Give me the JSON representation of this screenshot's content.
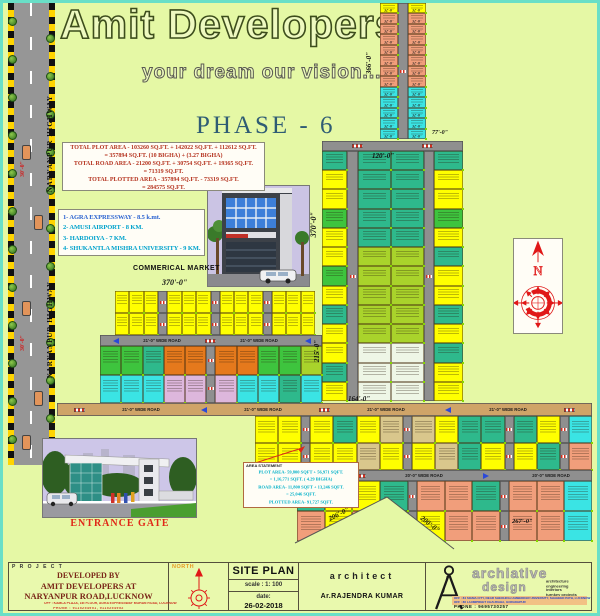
{
  "header": {
    "title": "Amit Developers",
    "tagline": "your dream our vision.......",
    "phase": "PHASE - 6"
  },
  "highway": {
    "label": "NARYANPUR HIGHWAY",
    "width_dim": "30'-0\""
  },
  "area_summary": {
    "l1": "TOTAL PLOT AREA -  103260 SQ.FT. + 142022 SQ.FT. + 112612 SQ.FT.",
    "l2": "= 357894 SQ.FT.    (10 BIGHA) + (3.27 BIGHA)",
    "l3": "TOTAL ROAD AREA -  21200 SQ.FT. + 30754 SQ.FT. + 19365 SQ.FT.",
    "l4": "= 71319 SQ.FT.",
    "l5": "TOTAL PLOTTED AREA - 357894 SQ.FT. - 73319 SQ.FT.",
    "l6": "= 284575 SQ.FT."
  },
  "distances": {
    "items": [
      "1- AGRA EXPRESSWAY - 8.5 k.mt.",
      "2- AMUSI AIRPORT - 8 KM.",
      "3- HARDOIYA - 7 KM.",
      "4- SHUKANTLA MISHRA UNIVERSITY - 9 KM."
    ]
  },
  "commercial_market_label": "COMMERICAL MARKET",
  "entrance_gate_label": "ENTRANCE GATE",
  "area_statement": {
    "header": "AREA STATEMENT",
    "l1": "PLOT AREA- 59,800 SQFT + 56,971 SQFT.",
    "l2": "= 1,16,771 SQFT. ( 4.29 BIGHA)",
    "l3": "ROAD AREA- 11,800 SQFT + 13,246 SQFT.",
    "l4": "= 25,046 SQFT.",
    "l5": "PLOTTED AREA- 91,727 SQFT."
  },
  "plan": {
    "road21": "21'-0\" WIDE ROAD",
    "road20": "20'-0\" WIDE ROAD",
    "strip_label": "32'-0\"",
    "d366": "366'-0\"",
    "d120": "120'-0\"",
    "d77": "77'-0\"",
    "d370a": "370'-0\"",
    "d370b": "370'-0\"",
    "d215": "215'-0\"",
    "d164": "164'-0\"",
    "d267": "267'-0\"",
    "d206": "206'-0\"",
    "d200": "200'-0\""
  },
  "titleblock": {
    "project_label": "P R O J E C T",
    "dev_line1": "DEVELOPED BY",
    "dev_line2": "AMIT DEVELOPERS AT",
    "dev_line3": "NARYANPUR ROAD,LUCKNOW",
    "office1": "OFF : KAMLA PLAZA, 1st FLOOR, AGRA EXPRESSWAY MOHAN ROAD, LUCKNOW",
    "phone1": "PHONE : 9115254951, 9115254952",
    "north_label": "NORTH",
    "siteplan": "SITE PLAN",
    "scale": "scale :  1: 100",
    "date_label": "date:",
    "date_value": "26-02-2018",
    "architect_label": "architect",
    "architect_name": "Ar.RAJENDRA KUMAR",
    "firm_name1": "archiative",
    "firm_name2": "design",
    "firm_services": [
      "architecture",
      "engineering",
      "interiors",
      "turnkey  projects"
    ],
    "firm_office1": "OFF : 84 SIGMA CITY, NEAR SHEOHRAJ AMBEDKER UNIVERSITY, SHAHEED PATH, LUCKNOW",
    "firm_office2": "OFF : 86 LAXMIPREET CHAURAHA, GORAKHPUR",
    "firm_phone": "PHONE :  9695730257"
  },
  "colors": {
    "background": "#e5f8a5",
    "frame": "#69dfc7",
    "road_gray": "#8f8f8f",
    "road_tan": "#cfa468",
    "checker_yellow": "#ffd400",
    "phase_text": "#2f5c74",
    "summary_text": "#b5331f",
    "distance_text": "#00a2cc",
    "entrance_label": "#e02818",
    "compass_red": "#e01818",
    "titleblock_maroon": "#7a2618"
  },
  "palette": {
    "Y": "#ffff00",
    "S": "#f19e7b",
    "C": "#3ae4e4",
    "T": "#2eb98c",
    "G": "#3ec43e",
    "YG": "#a9d32b",
    "W": "#eef6e6",
    "O": "#e5791c",
    "P": "#ddb7dc",
    "TN": "#d9c78c"
  },
  "plot_blocks": {
    "stripA": [
      "Y",
      "S",
      "S",
      "S",
      "S",
      "S",
      "S",
      "S",
      "C",
      "C",
      "C",
      "C",
      "C"
    ],
    "c_cL": [
      "T",
      "Y",
      "Y",
      "G",
      "Y",
      "Y",
      "G",
      "Y",
      "T",
      "Y",
      "Y",
      "T",
      "Y"
    ],
    "c_cC": [
      "T",
      "T",
      "T",
      "T",
      "T",
      "YG",
      "YG",
      "YG",
      "YG",
      "YG",
      "W",
      "W",
      "W"
    ],
    "c_cR": [
      "T",
      "Y",
      "Y",
      "G",
      "Y",
      "T",
      "Y",
      "Y",
      "T",
      "Y",
      "T",
      "Y",
      "Y"
    ],
    "d1": [
      "Y",
      "Y",
      "Y",
      "road",
      "Y",
      "Y",
      "Y",
      "road",
      "Y",
      "Y",
      "Y",
      "road",
      "Y",
      "Y",
      "Y"
    ],
    "d2r1": [
      "G",
      "G",
      "T",
      "O",
      "O",
      "road",
      "O",
      "O",
      "G",
      "G",
      "YG"
    ],
    "d2r2": [
      "C",
      "C",
      "C",
      "P",
      "P",
      "road",
      "P",
      "C",
      "C",
      "T",
      "C"
    ],
    "e1r1": [
      "Y",
      "Y",
      "road",
      "Y",
      "T",
      "Y",
      "TN",
      "road",
      "TN",
      "Y",
      "T",
      "T",
      "road",
      "T",
      "Y",
      "road",
      "C"
    ],
    "e1r2": [
      "Y",
      "Y",
      "road",
      "Y",
      "Y",
      "TN",
      "Y",
      "road",
      "Y",
      "TN",
      "T",
      "Y",
      "road",
      "Y",
      "T",
      "road",
      "S"
    ],
    "e2r1": [
      "T",
      "Y",
      "Y",
      "T",
      "road",
      "S",
      "S",
      "T",
      "road",
      "S",
      "S",
      "C"
    ],
    "e2r2": [
      "S",
      "Y",
      "S",
      "Y",
      "road",
      "Y",
      "S",
      "S",
      "road",
      "S",
      "S",
      "C"
    ]
  }
}
